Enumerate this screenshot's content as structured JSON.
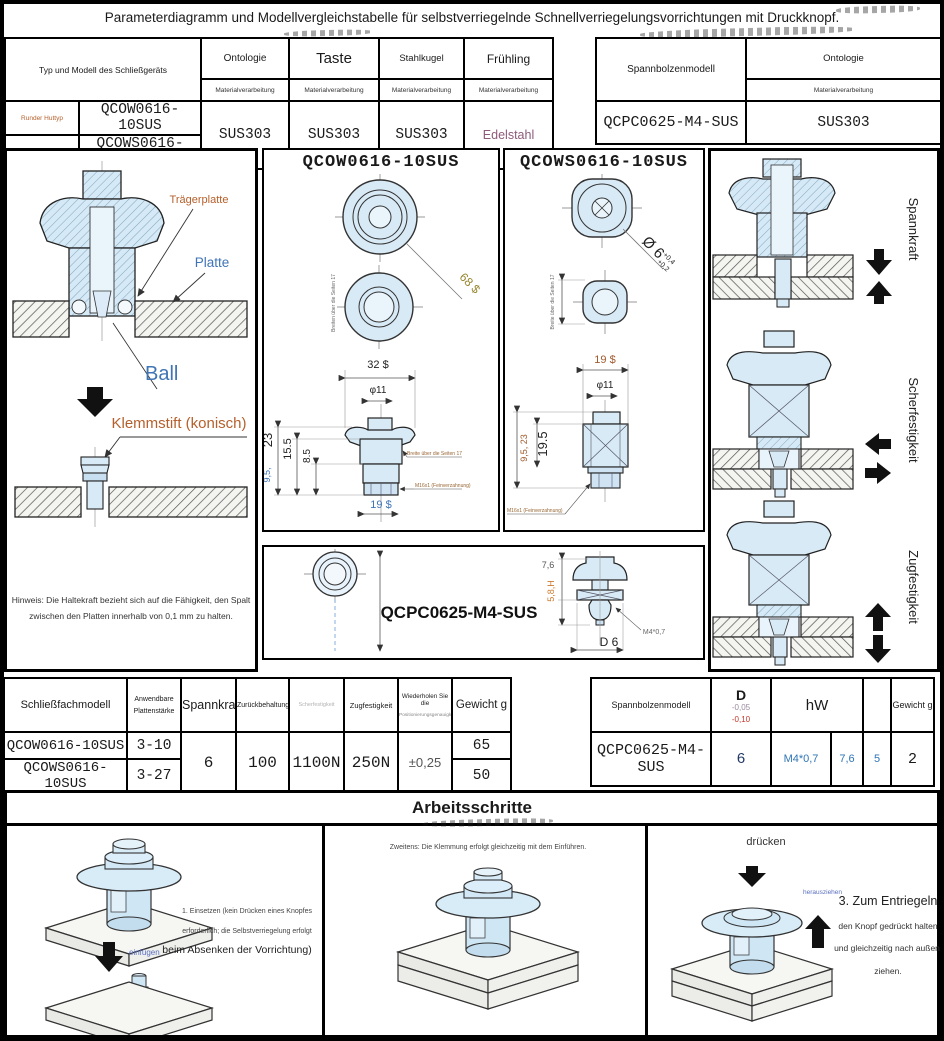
{
  "title": "Parameterdiagramm und Modellvergleichstabelle für selbstverriegelnde Schnellverriegelungsvorrichtungen mit Druckknopf.",
  "top_left_table": {
    "corner": "Typ und Modell des Schließgeräts",
    "cols": [
      "Ontologie",
      "Taste",
      "Stahlkugel",
      "Frühling"
    ],
    "sub": "Materialverarbeitung",
    "types": [
      "Runder Huttyp",
      "Zylindrisch"
    ],
    "models": [
      "QCOW0616-10SUS",
      "QCOWS0616-10SUS"
    ],
    "values": [
      "SUS303",
      "SUS303",
      "SUS303",
      "Edelstahl"
    ]
  },
  "top_right_table": {
    "corner": "Spannbolzenmodell",
    "col": "Ontologie",
    "sub": "Materialverarbeitung",
    "model": "QCPC0625-M4-SUS",
    "value": "SUS303"
  },
  "left_panel": {
    "traegerplatte": "Trägerplatte",
    "platte": "Platte",
    "ball": "Ball",
    "klemmstift": "Klemmstift (konisch)",
    "note1": "Hinweis: Die Haltekraft bezieht sich auf die Fähigkeit, den Spalt",
    "note2": "zwischen den Platten innerhalb von 0,1 mm zu halten."
  },
  "qcow": {
    "title": "QCOW0616-10SUS",
    "dim_68": "68 $",
    "across_top": "Breiten über die Seiten 17",
    "dim_32": "32 $",
    "dim_11": "φ11",
    "dim_23": "23",
    "dim_155": "15.5",
    "dim_85": "8.5",
    "dim_95": "9,5,",
    "dim_19": "19 $",
    "across_side": "Breite über die Seiten 17",
    "thread": "M16x1 (Feinverzahnung)"
  },
  "qcows": {
    "title": "QCOWS0616-10SUS",
    "dim_d6": "Ø 6",
    "tol_up": "+0,4",
    "tol_dn": "+0,2",
    "across": "Breite über die Seiten 17",
    "dim_19": "19 $",
    "dim_11": "φ11",
    "dim_95_23": "9,5, 23",
    "dim_195": "19.5",
    "thread": "M16x1 (Feinverzahnung)"
  },
  "qcpc": {
    "title": "QCPC0625-M4-SUS",
    "dim_76": "7,6",
    "dim_58": "5,8,H",
    "thread": "M4*0,7",
    "dim_d6": "D 6"
  },
  "right_panel": {
    "spannkraft": "Spannkraft",
    "scherfestigkeit": "Scherfestigkeit",
    "zugfestigkeit": "Zugfestigkeit"
  },
  "spec_table": {
    "h_model": "Schließfachmodell",
    "h_thickness1": "Anwendbare",
    "h_thickness2": "Plattenstärke",
    "h_spannkraft": "Spannkraft",
    "h_retention": "Zurückbehaltung",
    "h_shear": "Scherfestigkeit",
    "h_tensile": "Zugfestigkeit",
    "h_repeat1": "Wiederholen Sie die",
    "h_repeat2": "Positionierungsgenauigkeit",
    "h_weight": "Gewicht g",
    "models": [
      "QCOW0616-10SUS",
      "QCOWS0616-10SUS"
    ],
    "thickness": [
      "3-10",
      "3-27"
    ],
    "spannkraft": "6",
    "retention": "100",
    "shear": "1100N",
    "tensile": "250N",
    "repeat": "±0,25",
    "weights": [
      "65",
      "50"
    ]
  },
  "bolt_table": {
    "h_model": "Spannbolzenmodell",
    "h_d": "D",
    "d_tol1": "-0,05",
    "d_tol2": "-0,10",
    "h_hw": "hW",
    "h_weight": "Gewicht g",
    "model": "QCPC0625-M4-SUS",
    "d": "6",
    "thread": "M4*0,7",
    "h": "7,6",
    "w": "5",
    "weight": "2"
  },
  "steps": {
    "title": "Arbeitsschritte",
    "step1_arrow": "einfügen",
    "step1_l1": "1. Einsetzen (kein Drücken eines Knopfes",
    "step1_l2": "erforderlich; die Selbstverriegelung erfolgt",
    "step1_l3": "beim Absenken der Vorrichtung)",
    "step2": "Zweitens: Die Klemmung erfolgt gleichzeitig mit dem Einführen.",
    "step3_press": "drücken",
    "step3_pull": "herausziehen",
    "step3_l1": "3. Zum Entriegeln",
    "step3_l2": "den Knopf gedrückt halten",
    "step3_l3": "und gleichzeitig nach außen",
    "step3_l4": "ziehen."
  }
}
